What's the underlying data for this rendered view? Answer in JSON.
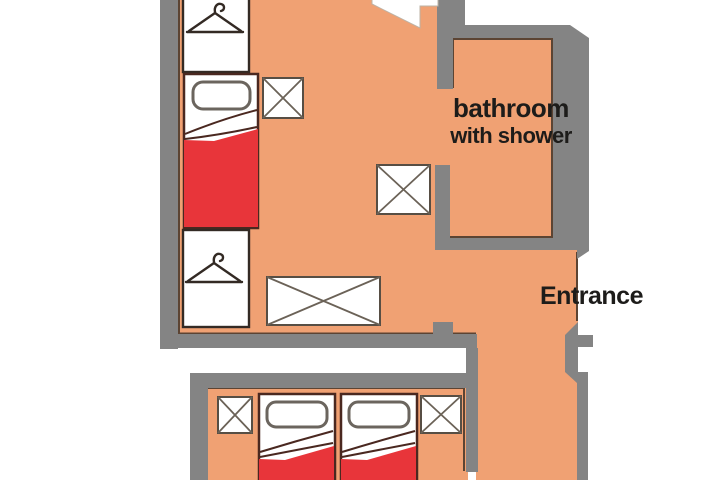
{
  "labels": {
    "bathroom_line1": "bathroom",
    "bathroom_line2": "with shower",
    "entrance": "Entrance"
  },
  "icons": {
    "wardrobe": "hanger-icon",
    "table": "cross-icon",
    "door": "door-swing-icon"
  },
  "colors": {
    "floor": "#F0A173",
    "wall": "#848484",
    "blanket": "#E8353A",
    "bed_outline": "#4A2820",
    "wardrobe_outline": "#332A24",
    "table_outline": "#574E44",
    "table_cross": "#6B6257",
    "pillow_outline": "#6B655E",
    "floor_outline": "#5C4433",
    "door_edge": "#BDB3A6",
    "text": "#1D1C1A"
  }
}
